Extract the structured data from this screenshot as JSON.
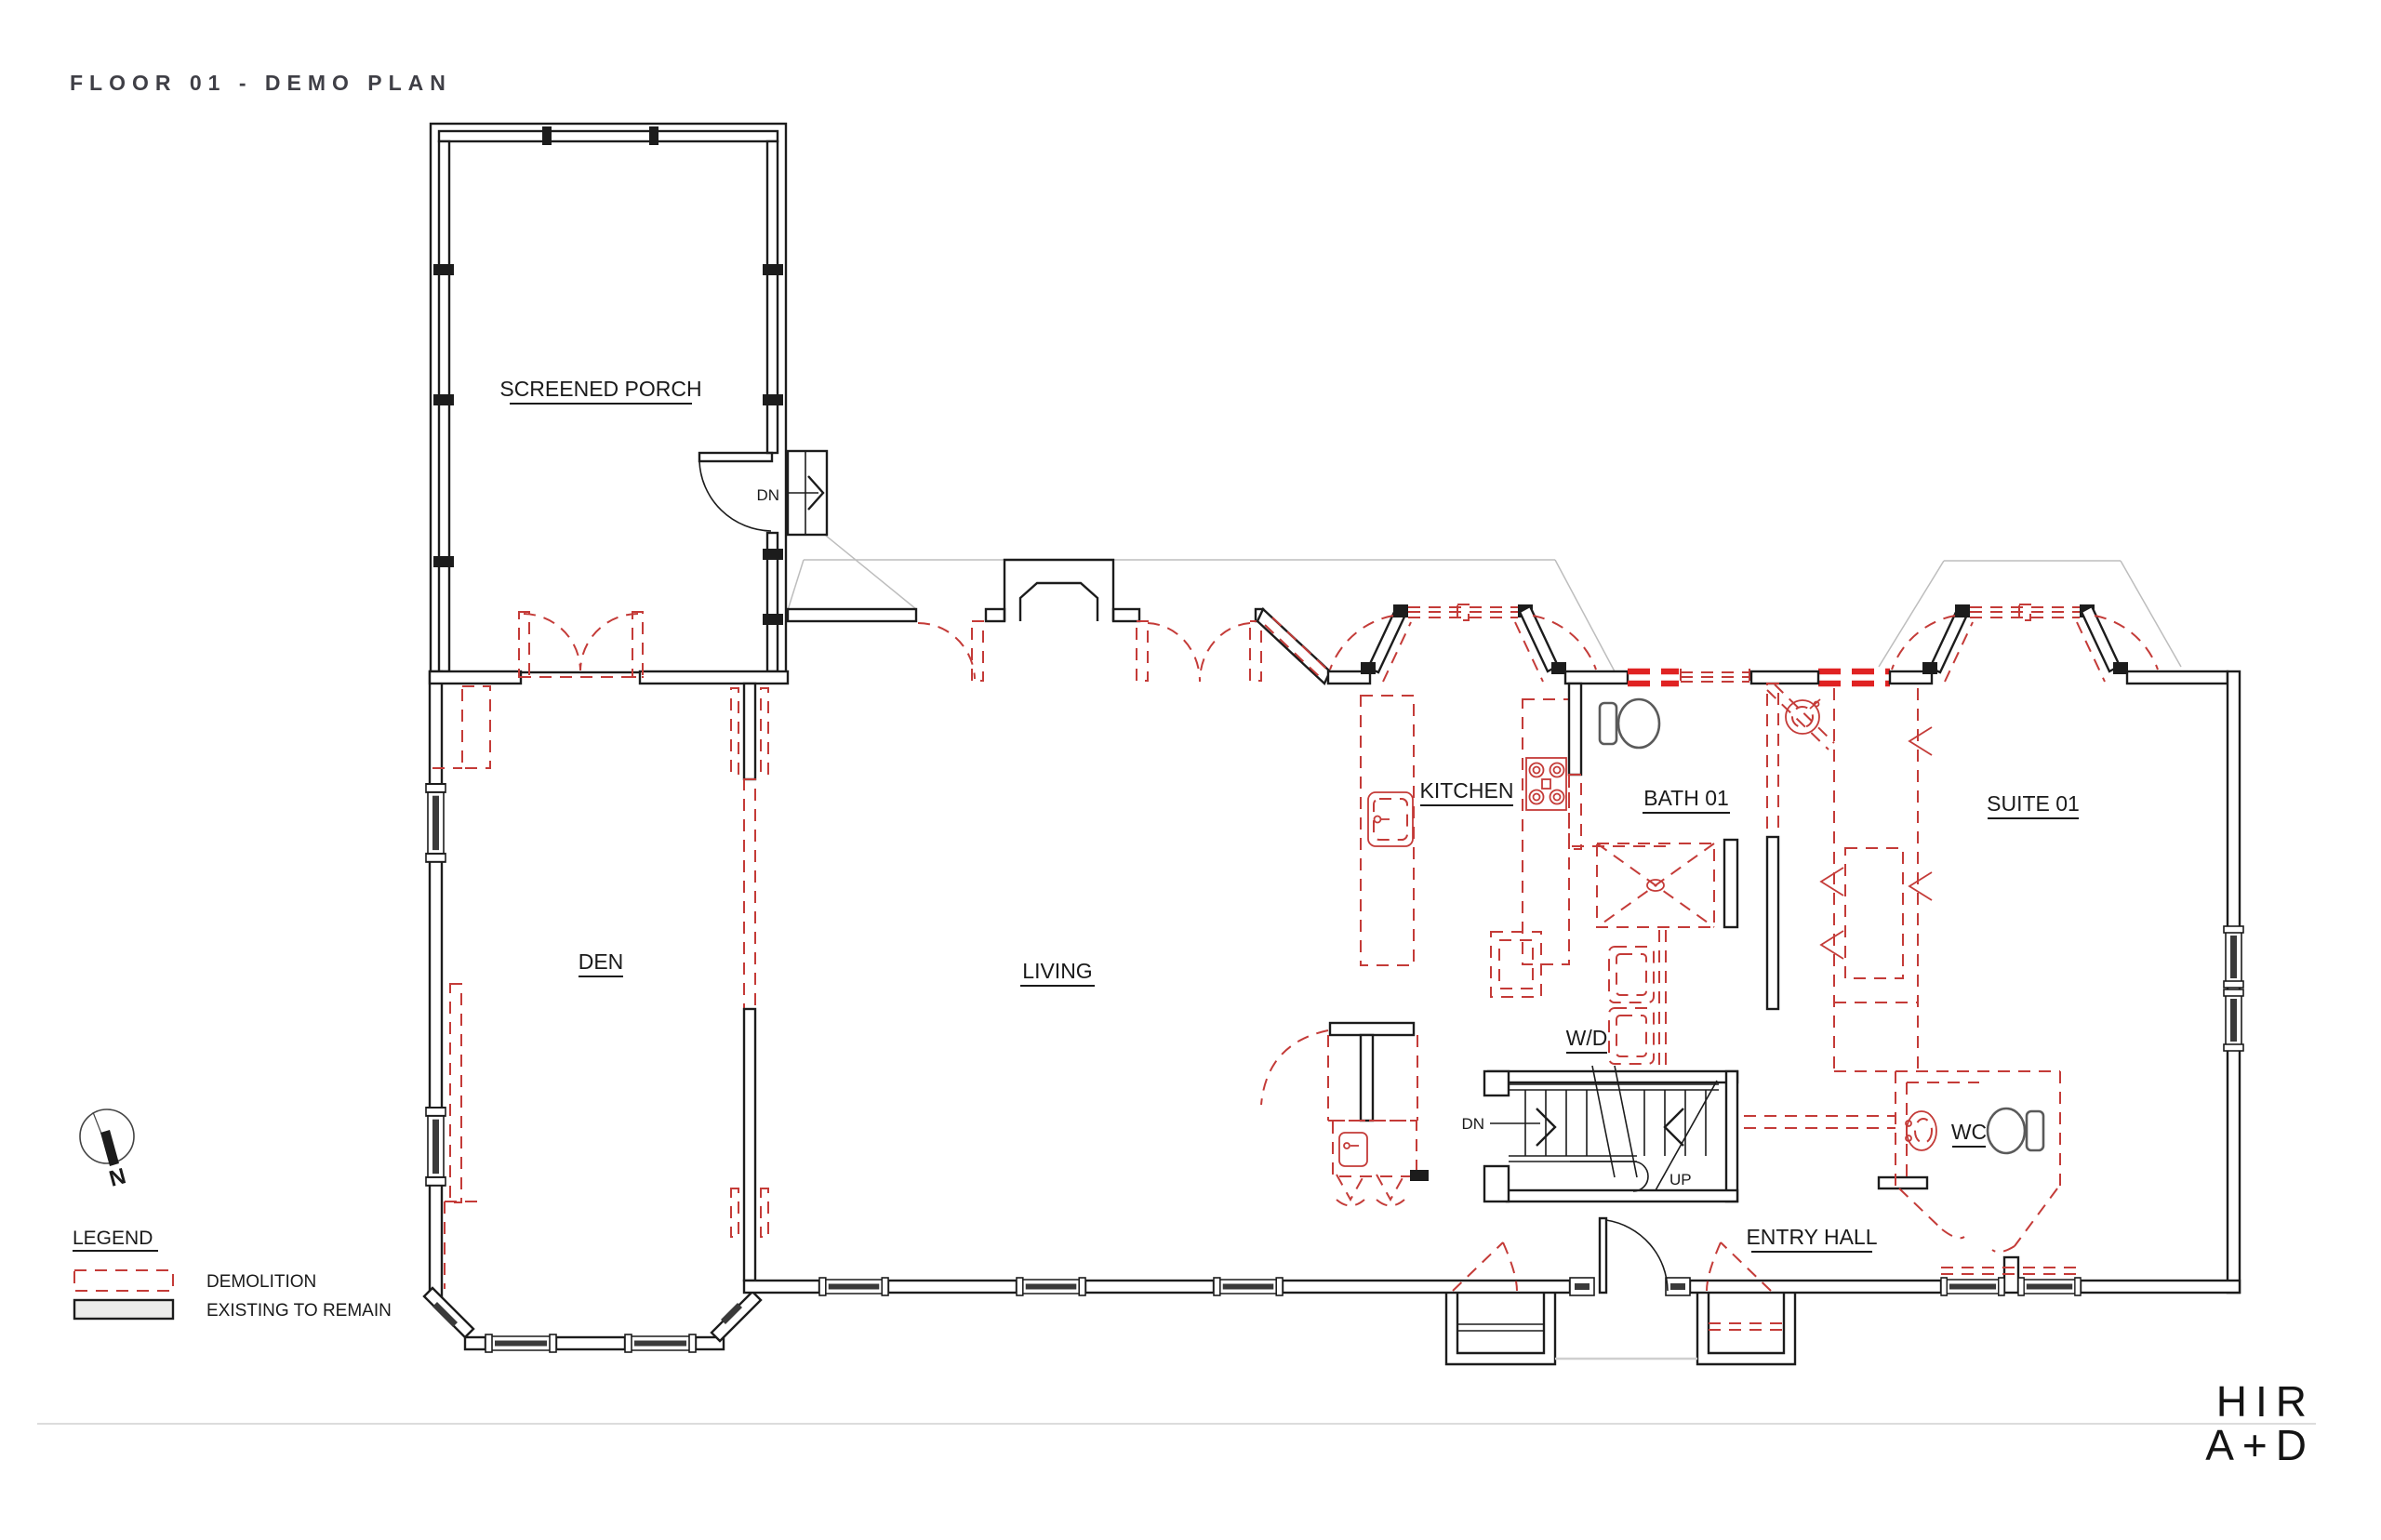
{
  "sheet": {
    "title": "FLOOR 01 - DEMO PLAN"
  },
  "rooms": [
    {
      "name": "screened-porch",
      "label": "SCREENED PORCH"
    },
    {
      "name": "den",
      "label": "DEN"
    },
    {
      "name": "living",
      "label": "LIVING"
    },
    {
      "name": "kitchen",
      "label": "KITCHEN"
    },
    {
      "name": "bath-01",
      "label": "BATH 01"
    },
    {
      "name": "suite-01",
      "label": "SUITE 01"
    },
    {
      "name": "wd",
      "label": "W/D"
    },
    {
      "name": "wc",
      "label": "WC"
    },
    {
      "name": "entry-hall",
      "label": "ENTRY HALL"
    }
  ],
  "annotations": {
    "porch_down": "DN",
    "stair_down": "DN",
    "stair_up": "UP",
    "north": "N"
  },
  "legend": {
    "heading": "LEGEND",
    "items": [
      {
        "label": "DEMOLITION",
        "style": "red-dashed"
      },
      {
        "label": "EXISTING TO REMAIN",
        "style": "solid-gray"
      }
    ]
  },
  "logo": {
    "line1": "HIR",
    "line2": "A+D"
  },
  "colors": {
    "demolition": "#c43b38",
    "demolition_bold": "#e02222",
    "wall": "#1c1c1c",
    "existing_fixture": "#5a5a5a",
    "roofline": "#bdbdbd",
    "title_text": "#3f3f46",
    "footer_rule": "#dcdcdc",
    "legend_existing_fill": "#ececea"
  }
}
